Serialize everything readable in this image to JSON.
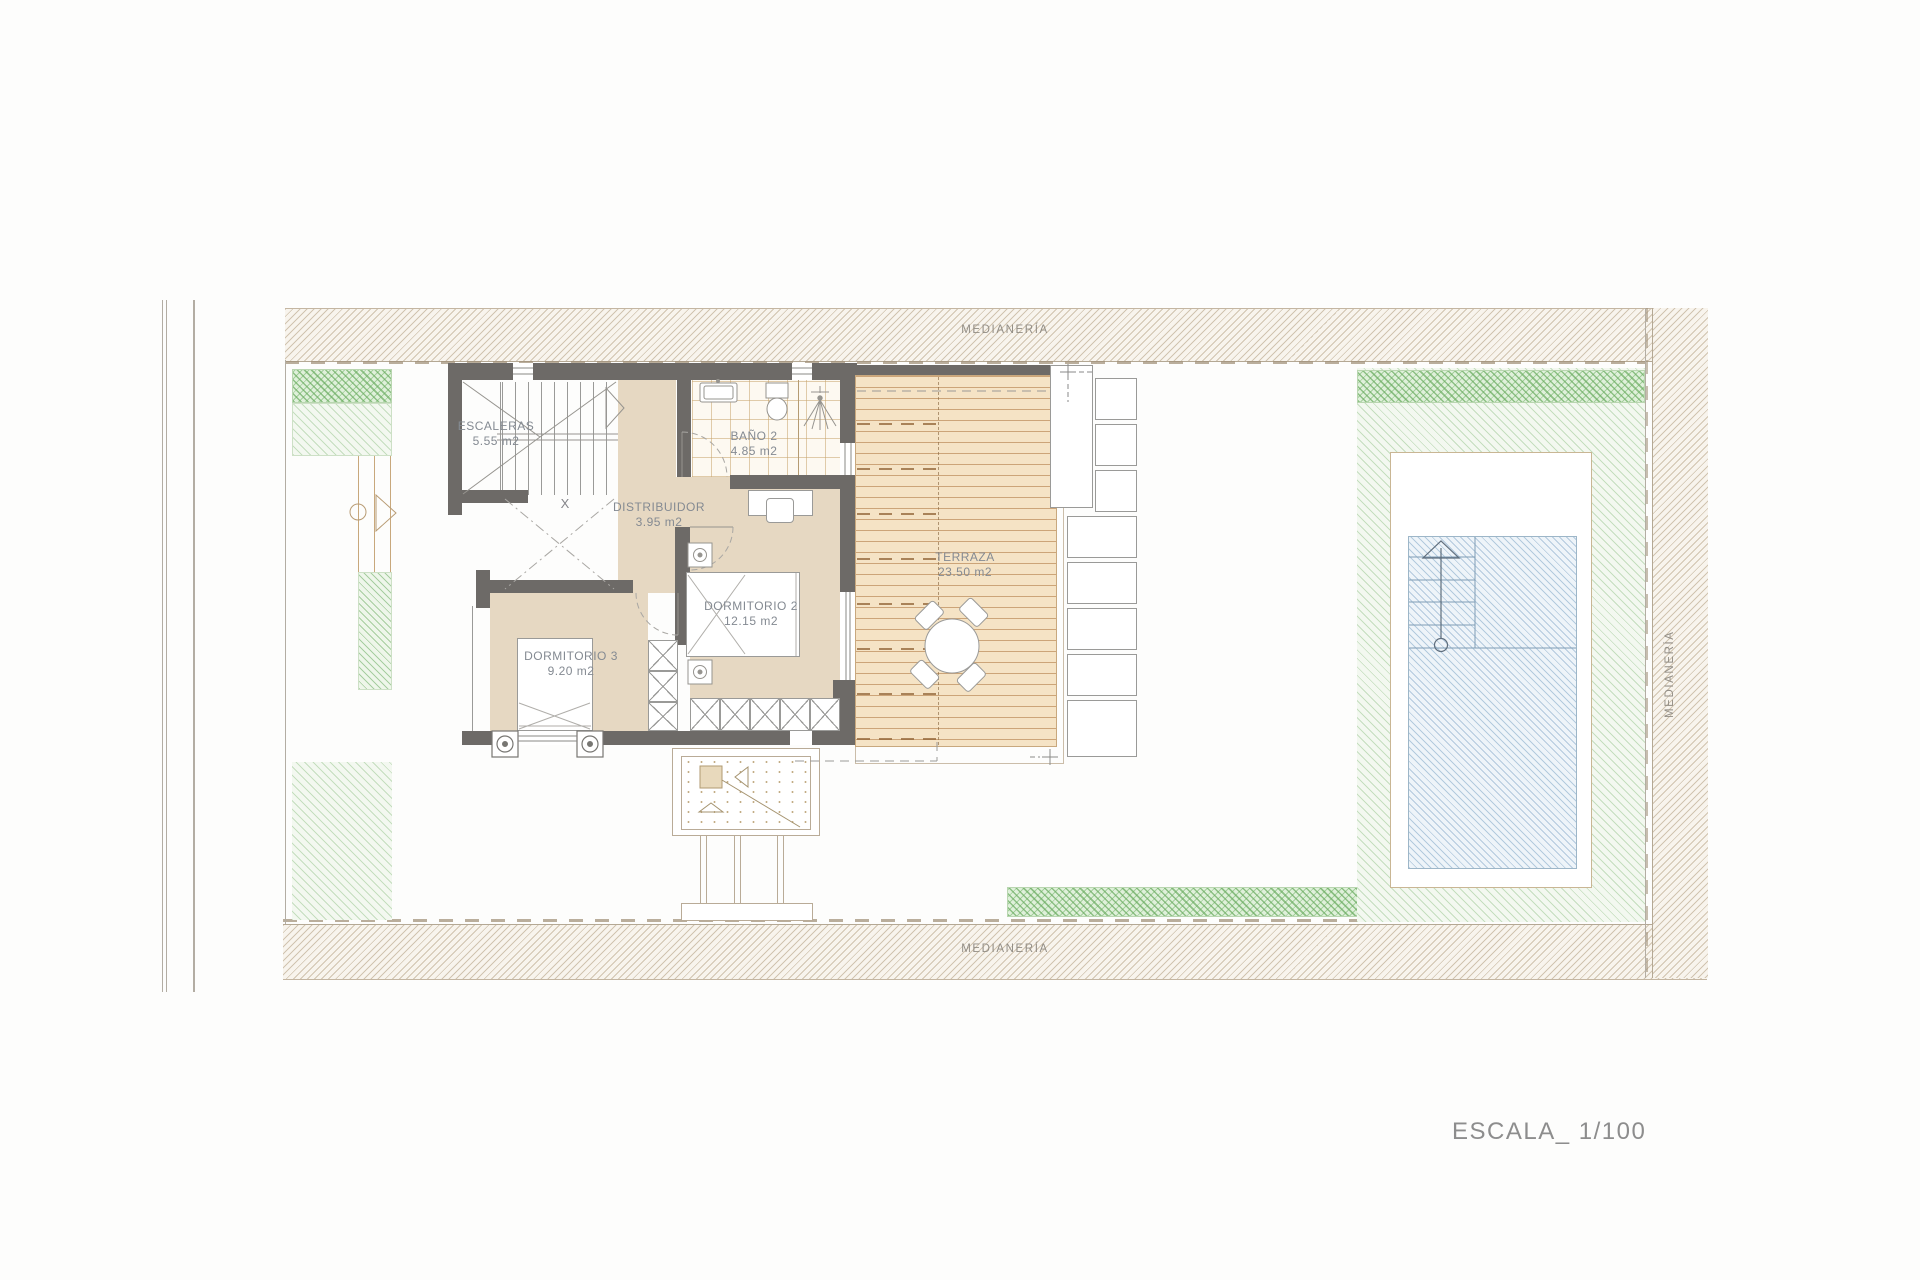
{
  "drawing": {
    "scale_label": "ESCALA_ 1/100",
    "boundary_label_top": "MEDIANERÍA",
    "boundary_label_bottom": "MEDIANERÍA",
    "boundary_label_right": "MEDIANERÍA",
    "void_marker": "X"
  },
  "rooms": {
    "escaleras": {
      "name": "ESCALERAS",
      "area": "5.55 m2"
    },
    "bano2": {
      "name": "BAÑO 2",
      "area": "4.85 m2"
    },
    "distribuidor": {
      "name": "DISTRIBUIDOR",
      "area": "3.95 m2"
    },
    "dormitorio2": {
      "name": "DORMITORIO 2",
      "area": "12.15 m2"
    },
    "dormitorio3": {
      "name": "DORMITORIO 3",
      "area": "9.20 m2"
    },
    "terraza": {
      "name": "TERRAZA",
      "area": "23.50 m2"
    }
  },
  "colors": {
    "wall": "#6d6a67",
    "floor_beige": "#e6d8c2",
    "deck": "#f5e3c5",
    "pool_fill": "#eef4f9",
    "pool_edge": "#9db6c8",
    "garden_green": "#7db877",
    "label_gray": "#848a92"
  }
}
